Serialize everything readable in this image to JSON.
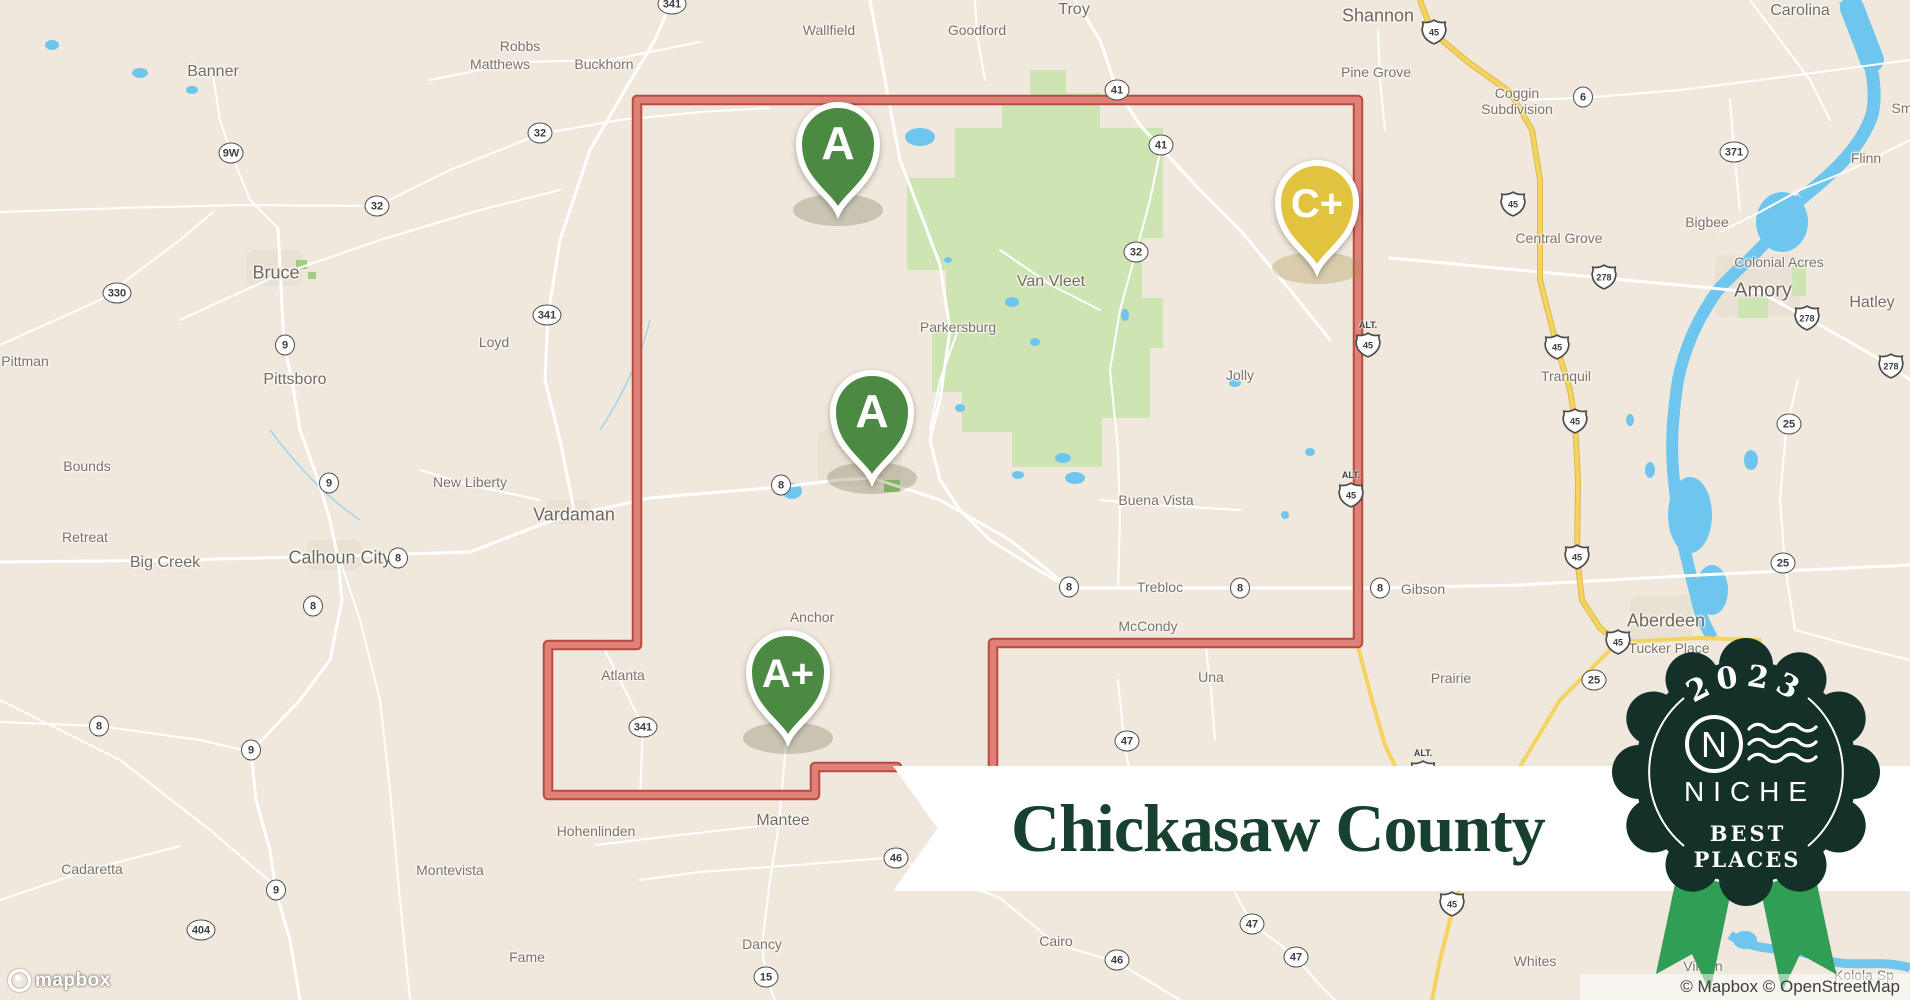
{
  "banner": {
    "title": "Chickasaw County"
  },
  "badge": {
    "year": "2023",
    "brand": "NICHE",
    "tagline_line1": "BEST",
    "tagline_line2": "PLACES"
  },
  "attribution": {
    "text": "© Mapbox © OpenStreetMap"
  },
  "logo": {
    "text": "mapbox"
  },
  "markers": [
    {
      "grade": "A",
      "color": "#4c8a44",
      "x": 838,
      "y": 212,
      "shadow": "rgba(100,104,66,0.28)"
    },
    {
      "grade": "A",
      "color": "#4c8a44",
      "x": 872,
      "y": 480,
      "shadow": "rgba(100,104,66,0.28)"
    },
    {
      "grade": "A+",
      "color": "#4c8a44",
      "x": 788,
      "y": 740,
      "shadow": "rgba(100,104,66,0.28)"
    },
    {
      "grade": "C+",
      "color": "#e2c33f",
      "x": 1317,
      "y": 270,
      "shadow": "rgba(163,140,60,0.30)"
    }
  ],
  "towns": [
    {
      "name": "Wallfield",
      "x": 829,
      "y": 30,
      "s": "s"
    },
    {
      "name": "Goodford",
      "x": 977,
      "y": 30,
      "s": "s"
    },
    {
      "name": "Troy",
      "x": 1074,
      "y": 10,
      "s": "m"
    },
    {
      "name": "Shannon",
      "x": 1378,
      "y": 16,
      "s": "l"
    },
    {
      "name": "Carolina",
      "x": 1800,
      "y": 11,
      "s": "m"
    },
    {
      "name": "Robbs",
      "x": 520,
      "y": 46,
      "s": "s"
    },
    {
      "name": "Matthews",
      "x": 500,
      "y": 64,
      "s": "s"
    },
    {
      "name": "Buckhorn",
      "x": 604,
      "y": 64,
      "s": "s"
    },
    {
      "name": "Pine Grove",
      "x": 1376,
      "y": 72,
      "s": "s"
    },
    {
      "name": "Coggin",
      "name2": "Subdivision",
      "x": 1517,
      "y": 101,
      "s": "s"
    },
    {
      "name": "Banner",
      "x": 213,
      "y": 72,
      "s": "m"
    },
    {
      "name": "Flinn",
      "x": 1866,
      "y": 158,
      "s": "s"
    },
    {
      "name": "Bigbee",
      "x": 1707,
      "y": 222,
      "s": "s"
    },
    {
      "name": "Central Grove",
      "x": 1559,
      "y": 238,
      "s": "s"
    },
    {
      "name": "Colonial Acres",
      "x": 1779,
      "y": 262,
      "s": "s"
    },
    {
      "name": "Amory",
      "x": 1763,
      "y": 291,
      "s": "x"
    },
    {
      "name": "Hatley",
      "x": 1872,
      "y": 303,
      "s": "m"
    },
    {
      "name": "Bruce",
      "x": 276,
      "y": 273,
      "s": "l"
    },
    {
      "name": "Loyd",
      "x": 494,
      "y": 342,
      "s": "s"
    },
    {
      "name": "Pittman",
      "x": 25,
      "y": 361,
      "s": "s"
    },
    {
      "name": "Pittsboro",
      "x": 295,
      "y": 380,
      "s": "m"
    },
    {
      "name": "Van Vleet",
      "x": 1051,
      "y": 282,
      "s": "m"
    },
    {
      "name": "Parkersburg",
      "x": 958,
      "y": 327,
      "s": "s"
    },
    {
      "name": "Tranquil",
      "x": 1566,
      "y": 376,
      "s": "s"
    },
    {
      "name": "Jolly",
      "x": 1240,
      "y": 375,
      "s": "s"
    },
    {
      "name": "Bounds",
      "x": 87,
      "y": 466,
      "s": "s"
    },
    {
      "name": "New Liberty",
      "x": 470,
      "y": 482,
      "s": "s"
    },
    {
      "name": "Vardaman",
      "x": 574,
      "y": 515,
      "s": "l"
    },
    {
      "name": "Retreat",
      "x": 85,
      "y": 537,
      "s": "s"
    },
    {
      "name": "Big Creek",
      "x": 165,
      "y": 563,
      "s": "m"
    },
    {
      "name": "Calhoun City",
      "x": 340,
      "y": 558,
      "s": "l"
    },
    {
      "name": "Buena Vista",
      "x": 1156,
      "y": 500,
      "s": "s"
    },
    {
      "name": "Trebloc",
      "x": 1160,
      "y": 587,
      "s": "s"
    },
    {
      "name": "Gibson",
      "x": 1423,
      "y": 589,
      "s": "s"
    },
    {
      "name": "McCondy",
      "x": 1148,
      "y": 626,
      "s": "s"
    },
    {
      "name": "Aberdeen",
      "x": 1666,
      "y": 621,
      "s": "l"
    },
    {
      "name": "Tucker Place",
      "x": 1669,
      "y": 648,
      "s": "s"
    },
    {
      "name": "Anchor",
      "x": 812,
      "y": 617,
      "s": "s"
    },
    {
      "name": "Atlanta",
      "x": 623,
      "y": 675,
      "s": "s"
    },
    {
      "name": "Una",
      "x": 1211,
      "y": 677,
      "s": "s"
    },
    {
      "name": "Prairie",
      "x": 1451,
      "y": 678,
      "s": "s"
    },
    {
      "name": "Hohenlinden",
      "x": 596,
      "y": 831,
      "s": "s"
    },
    {
      "name": "Mantee",
      "x": 783,
      "y": 821,
      "s": "m"
    },
    {
      "name": "Montevista",
      "x": 450,
      "y": 870,
      "s": "s"
    },
    {
      "name": "Cadaretta",
      "x": 92,
      "y": 869,
      "s": "s"
    },
    {
      "name": "Cairo",
      "x": 1056,
      "y": 941,
      "s": "s"
    },
    {
      "name": "Fame",
      "x": 527,
      "y": 957,
      "s": "s"
    },
    {
      "name": "Dancy",
      "x": 762,
      "y": 944,
      "s": "s"
    },
    {
      "name": "Whites",
      "x": 1535,
      "y": 961,
      "s": "s"
    },
    {
      "name": "Vinton",
      "x": 1703,
      "y": 966,
      "s": "s"
    },
    {
      "name": "Kolola Sp",
      "x": 1864,
      "y": 975,
      "s": "s"
    },
    {
      "name": "Sm",
      "x": 1902,
      "y": 108,
      "s": "s"
    }
  ],
  "route_shields_circle": [
    {
      "num": "341",
      "x": 672,
      "y": 4
    },
    {
      "num": "41",
      "x": 1117,
      "y": 90
    },
    {
      "num": "41",
      "x": 1161,
      "y": 145
    },
    {
      "num": "32",
      "x": 540,
      "y": 133
    },
    {
      "num": "9W",
      "x": 231,
      "y": 153
    },
    {
      "num": "32",
      "x": 377,
      "y": 206
    },
    {
      "num": "330",
      "x": 117,
      "y": 293
    },
    {
      "num": "9",
      "x": 285,
      "y": 345
    },
    {
      "num": "341",
      "x": 547,
      "y": 315
    },
    {
      "num": "32",
      "x": 1136,
      "y": 252
    },
    {
      "num": "9",
      "x": 329,
      "y": 483
    },
    {
      "num": "8",
      "x": 781,
      "y": 485
    },
    {
      "num": "8",
      "x": 398,
      "y": 558
    },
    {
      "num": "8",
      "x": 313,
      "y": 606
    },
    {
      "num": "8",
      "x": 99,
      "y": 726
    },
    {
      "num": "9",
      "x": 251,
      "y": 750
    },
    {
      "num": "8",
      "x": 1069,
      "y": 587
    },
    {
      "num": "8",
      "x": 1240,
      "y": 588
    },
    {
      "num": "8",
      "x": 1380,
      "y": 588
    },
    {
      "num": "25",
      "x": 1789,
      "y": 424
    },
    {
      "num": "25",
      "x": 1783,
      "y": 563
    },
    {
      "num": "25",
      "x": 1594,
      "y": 680
    },
    {
      "num": "341",
      "x": 643,
      "y": 727
    },
    {
      "num": "47",
      "x": 1127,
      "y": 741
    },
    {
      "num": "46",
      "x": 896,
      "y": 858
    },
    {
      "num": "9",
      "x": 276,
      "y": 890
    },
    {
      "num": "404",
      "x": 201,
      "y": 930
    },
    {
      "num": "15",
      "x": 766,
      "y": 977
    },
    {
      "num": "46",
      "x": 1117,
      "y": 960
    },
    {
      "num": "47",
      "x": 1252,
      "y": 924
    },
    {
      "num": "47",
      "x": 1296,
      "y": 957
    },
    {
      "num": "6",
      "x": 1583,
      "y": 97
    },
    {
      "num": "371",
      "x": 1734,
      "y": 152
    }
  ],
  "route_shields_us": [
    {
      "num": "45",
      "x": 1434,
      "y": 32
    },
    {
      "num": "45",
      "x": 1513,
      "y": 204
    },
    {
      "num": "45",
      "x": 1557,
      "y": 347
    },
    {
      "num": "45",
      "x": 1575,
      "y": 421
    },
    {
      "num": "45",
      "x": 1577,
      "y": 557
    },
    {
      "num": "45",
      "x": 1618,
      "y": 642
    },
    {
      "num": "45",
      "x": 1452,
      "y": 904
    },
    {
      "num": "278",
      "x": 1604,
      "y": 277
    },
    {
      "num": "278",
      "x": 1807,
      "y": 318
    },
    {
      "num": "278",
      "x": 1891,
      "y": 366
    },
    {
      "num": "45",
      "x": 1368,
      "y": 340,
      "alt": true
    },
    {
      "num": "45",
      "x": 1351,
      "y": 490,
      "alt": true
    },
    {
      "num": "45",
      "x": 1423,
      "y": 768,
      "alt": true
    }
  ],
  "colors": {
    "map_bg": "#f0e8dd",
    "forest": "#cfe4b3",
    "water": "#6ec6ee",
    "road_yellow": "#f4d35e",
    "county_border_outer": "#b84a41",
    "county_border_inner": "#df8177",
    "banner_text": "#17402e",
    "badge_bg": "#143129",
    "ribbon_green": "#2f9f55",
    "pin_green": "#4c8a44",
    "pin_yellow": "#e2c33f"
  }
}
